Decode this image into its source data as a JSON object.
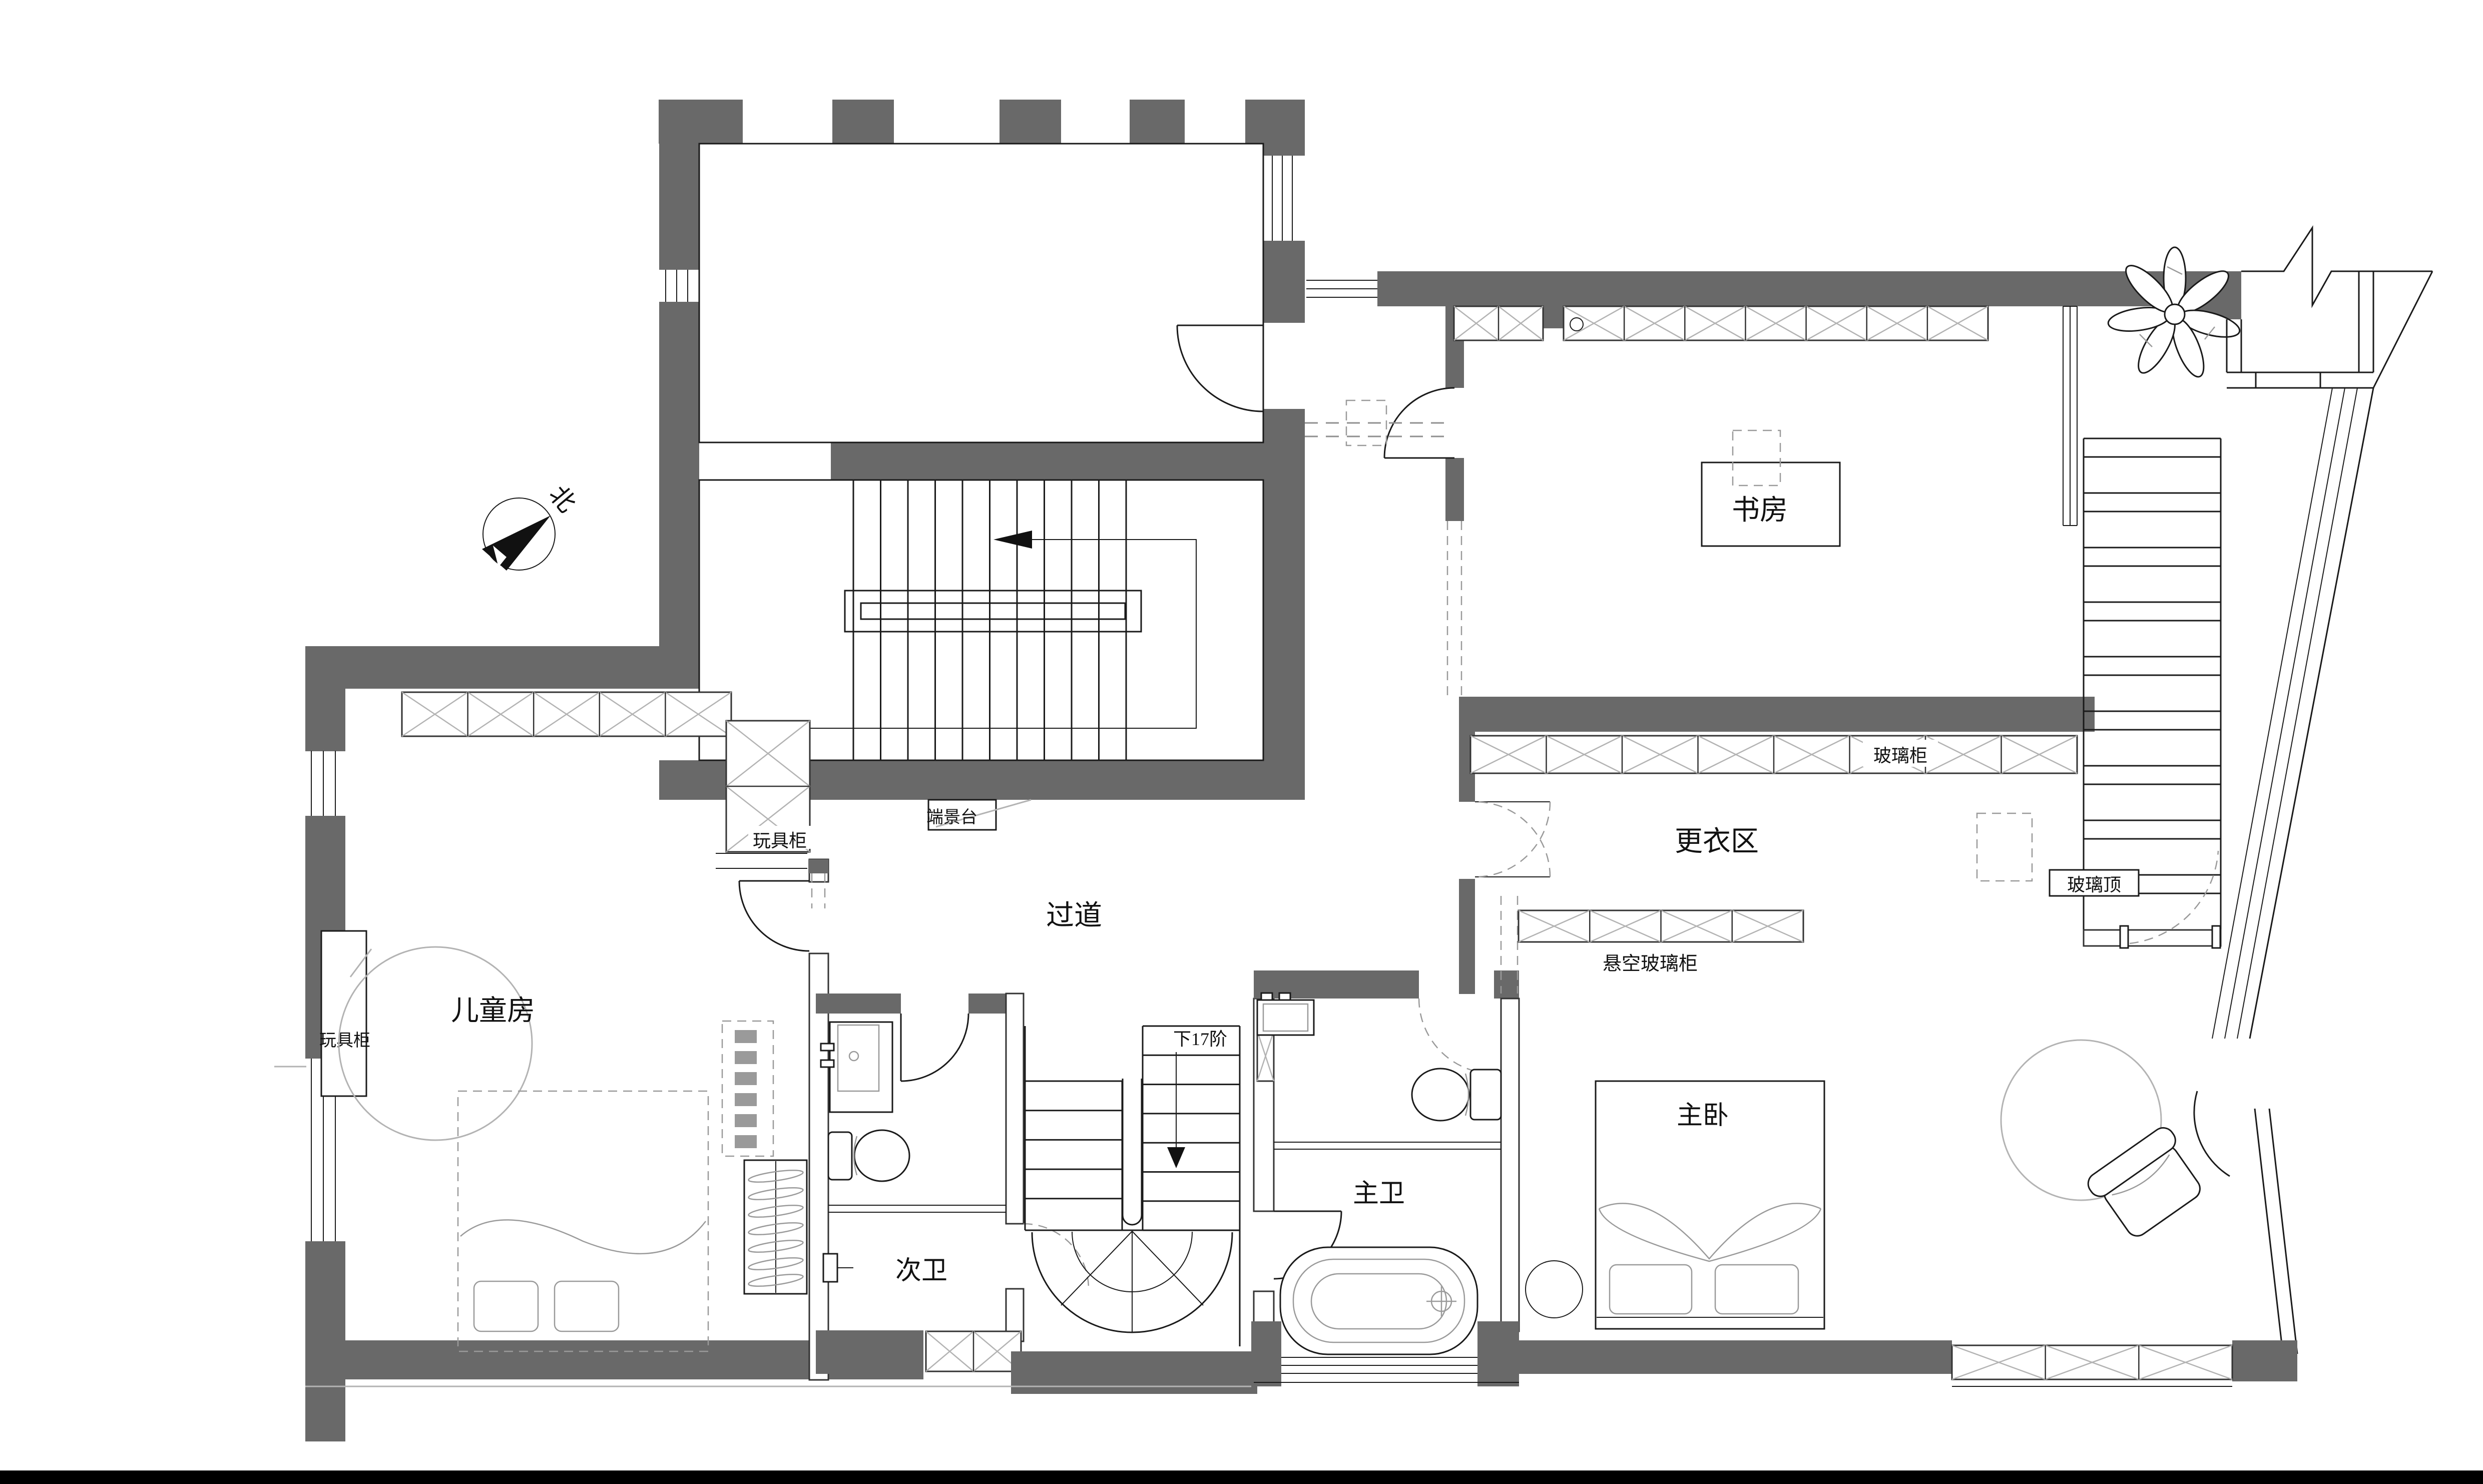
{
  "document": {
    "type": "residential-floor-plan",
    "floor_note": "second floor plan with three staircases"
  },
  "colors": {
    "wall_fill": "#696969",
    "line": "#1a1a1a",
    "hatch": "#b3b3b3",
    "dashed": "#9a9a9a",
    "background": "#ffffff",
    "footer_bar": "#000000"
  },
  "compass": {
    "north_label": "北"
  },
  "rooms": {
    "study": "书房",
    "dressing": "更衣区",
    "corridor": "过道",
    "kids": "儿童房",
    "master": "主卧",
    "master_bath": "主卫",
    "second_bath": "次卫"
  },
  "annotations": {
    "glass_cabinet": "玻璃柜",
    "glass_roof": "玻璃顶",
    "floating_glass_cabinet": "悬空玻璃柜",
    "end_console": "端景台",
    "toy_cabinet_right": "玩具柜",
    "toy_cabinet_left": "玩具柜",
    "stairs_down": "下17阶"
  }
}
